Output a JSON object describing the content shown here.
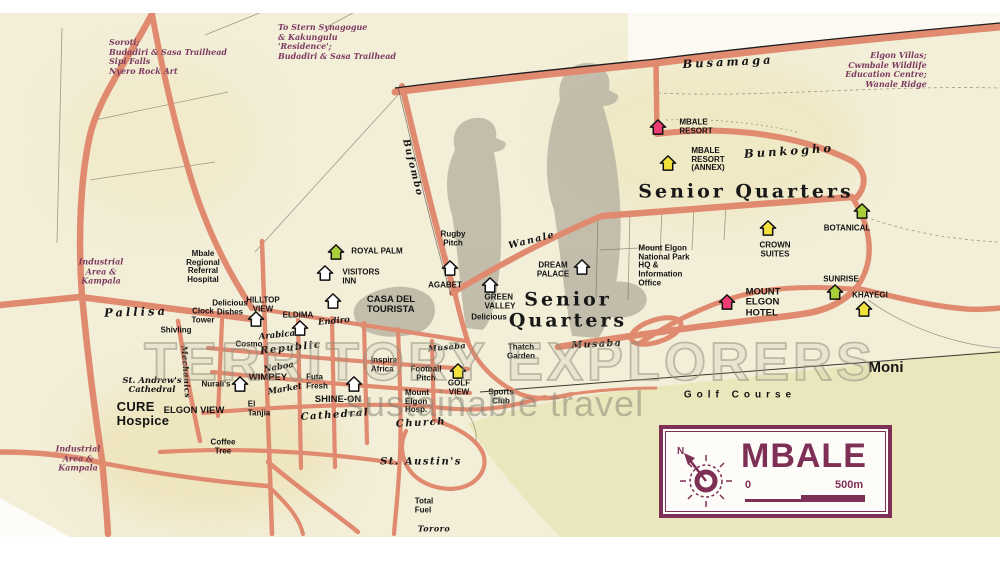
{
  "colors": {
    "road": "#e08a70",
    "paper": "#f3eed8",
    "legend_accent": "#7e2f55",
    "golf": "#eae5ba"
  },
  "legend": {
    "title": "MBALE",
    "scale_start": "0",
    "scale_end": "500m"
  },
  "watermark": {
    "line1": "TERRITORY EXPLORERS",
    "line2": "sustainable travel"
  },
  "map": {
    "labels": [
      {
        "n": "soroti-note",
        "t": "Soroti;\nBudadiri & Sasa Trailhead\nSipi Falls\nNyero Rock Art",
        "x": 168,
        "y": 57,
        "c": "note al"
      },
      {
        "n": "synagogue-note",
        "t": "To Stern Synagogue\n& Kakungulu\n'Residence';\nBudadiri & Sasa Trailhead",
        "x": 337,
        "y": 42,
        "c": "note al"
      },
      {
        "n": "elgon-villas-note",
        "t": "Elgon Villas;\nCwmbale Wildlife\nEducation Centre;\nWanale Ridge",
        "x": 886,
        "y": 70,
        "c": "note ar"
      },
      {
        "n": "industrial-kampala-note-1",
        "t": "Industrial\nArea &\nKampala",
        "x": 101,
        "y": 272,
        "c": "note"
      },
      {
        "n": "industrial-kampala-note-2",
        "t": "Industrial\nArea &\nKampala",
        "x": 78,
        "y": 459,
        "c": "note"
      },
      {
        "n": "busamaga-road-label",
        "t": "Busamaga",
        "x": 728,
        "y": 62,
        "c": "rdlg",
        "r": -3
      },
      {
        "n": "bunkogho-road-label",
        "t": "Bunkogho",
        "x": 789,
        "y": 151,
        "c": "rdlg",
        "r": -4
      },
      {
        "n": "bufombo-road-label",
        "t": "Bufombo",
        "x": 412,
        "y": 168,
        "c": "rdmd",
        "r": 76
      },
      {
        "n": "wanale-road-label",
        "t": "Wanale",
        "x": 532,
        "y": 241,
        "c": "rdmd",
        "r": -14
      },
      {
        "n": "pallisa-road-label",
        "t": "Pallisa",
        "x": 136,
        "y": 312,
        "c": "rdlg",
        "r": -2
      },
      {
        "n": "musaba-road-label-small",
        "t": "Musaba",
        "x": 447,
        "y": 347,
        "c": "rdsm",
        "r": -5
      },
      {
        "n": "musaba-road-label",
        "t": "Musaba",
        "x": 597,
        "y": 345,
        "c": "rdmd",
        "r": -3
      },
      {
        "n": "mechanics-road-label",
        "t": "Mechanics",
        "x": 186,
        "y": 372,
        "c": "rdsm",
        "r": 86
      },
      {
        "n": "naboa-road-label",
        "t": "Naboa",
        "x": 279,
        "y": 368,
        "c": "itsm",
        "r": -10
      },
      {
        "n": "market-road-label",
        "t": "Market",
        "x": 285,
        "y": 390,
        "c": "itsm",
        "r": -10
      },
      {
        "n": "cathedral-road-label",
        "t": "Cathedral",
        "x": 335,
        "y": 416,
        "c": "itmd",
        "r": -4
      },
      {
        "n": "church-road-label",
        "t": "Church",
        "x": 421,
        "y": 424,
        "c": "itmd",
        "r": -3
      },
      {
        "n": "tororo-road-label",
        "t": "Tororo",
        "x": 434,
        "y": 529,
        "c": "rdsm"
      },
      {
        "n": "republic-road-label",
        "t": "Republic",
        "x": 291,
        "y": 349,
        "c": "itmd",
        "r": -6
      },
      {
        "n": "arabica-road-label",
        "t": "Arabica",
        "x": 277,
        "y": 336,
        "c": "itsm",
        "r": -6
      },
      {
        "n": "senior-quarters-label-1",
        "t": "Senior Quarters",
        "x": 746,
        "y": 192,
        "c": "area"
      },
      {
        "n": "senior-quarters-label-2",
        "t": "Senior\nQuarters",
        "x": 568,
        "y": 310,
        "c": "area"
      },
      {
        "n": "moni-label",
        "t": "Moni",
        "x": 886,
        "y": 368,
        "c": "moni"
      },
      {
        "n": "golf-course-label",
        "t": "Golf Course",
        "x": 740,
        "y": 396,
        "c": "golfc"
      },
      {
        "n": "mbale-resort-label",
        "t": "MBALE\nRESORT",
        "x": 696,
        "y": 127,
        "c": "al"
      },
      {
        "n": "mbale-resort-annex-label",
        "t": "MBALE\nRESORT\n(ANNEX)",
        "x": 708,
        "y": 160,
        "c": "al"
      },
      {
        "n": "botanical-label",
        "t": "BOTANICAL",
        "x": 847,
        "y": 229
      },
      {
        "n": "crown-suites-label",
        "t": "CROWN\nSUITES",
        "x": 775,
        "y": 250
      },
      {
        "n": "sunrise-label",
        "t": "SUNRISE",
        "x": 841,
        "y": 280
      },
      {
        "n": "khayegi-label",
        "t": "KHAYEGI",
        "x": 870,
        "y": 296
      },
      {
        "n": "np-office-label",
        "t": "Mount Elgon\nNational Park\nHQ &\nInformation\nOffice",
        "x": 664,
        "y": 266,
        "c": "al"
      },
      {
        "n": "mount-elgon-hotel-label",
        "t": "MOUNT\nELGON\nHOTEL",
        "x": 763,
        "y": 303,
        "c": "p9 al"
      },
      {
        "n": "royal-palm-label",
        "t": "ROYAL PALM",
        "x": 377,
        "y": 252
      },
      {
        "n": "visitors-inn-label",
        "t": "VISITORS\nINN",
        "x": 361,
        "y": 277,
        "c": "al"
      },
      {
        "n": "casa-del-tourista-label",
        "t": "CASA DEL\nTOURISTA",
        "x": 391,
        "y": 305,
        "c": "p9 al"
      },
      {
        "n": "agabet-label",
        "t": "AGABET",
        "x": 445,
        "y": 286
      },
      {
        "n": "rugby-pitch-label",
        "t": "Rugby\nPitch",
        "x": 453,
        "y": 239
      },
      {
        "n": "dream-palace-label",
        "t": "DREAM\nPALACE",
        "x": 553,
        "y": 270
      },
      {
        "n": "green-valley-label",
        "t": "GREEN\nVALLEY",
        "x": 500,
        "y": 302,
        "c": "al"
      },
      {
        "n": "delicious-label",
        "t": "Delicious",
        "x": 489,
        "y": 318
      },
      {
        "n": "thatch-garden-label",
        "t": "Thatch\nGarden",
        "x": 521,
        "y": 352
      },
      {
        "n": "football-pitch-label",
        "t": "Football\nPitch",
        "x": 426,
        "y": 374
      },
      {
        "n": "golf-view-label",
        "t": "GOLF\nVIEW",
        "x": 459,
        "y": 388
      },
      {
        "n": "sports-club-label",
        "t": "Sports\nClub",
        "x": 501,
        "y": 397
      },
      {
        "n": "mount-elgon-hosp-label",
        "t": "Mount\nElgon\nHosp.",
        "x": 417,
        "y": 402,
        "c": "al"
      },
      {
        "n": "inspire-africa-label",
        "t": "Inspire\nAfrica",
        "x": 384,
        "y": 365,
        "c": "al"
      },
      {
        "n": "shine-on-label",
        "t": "SHINE-ON",
        "x": 338,
        "y": 400,
        "c": "p9"
      },
      {
        "n": "futa-fresh-label",
        "t": "Futa\nFresh",
        "x": 317,
        "y": 382,
        "c": "al"
      },
      {
        "n": "wimpey-label",
        "t": "WIMPEY",
        "x": 268,
        "y": 378,
        "c": "p9"
      },
      {
        "n": "eldima-label",
        "t": "ELDIMA",
        "x": 298,
        "y": 316
      },
      {
        "n": "hilltop-view-label",
        "t": "HILLTOP\nVIEW",
        "x": 263,
        "y": 305
      },
      {
        "n": "delicious-dishes-label",
        "t": "Delicious\nDishes",
        "x": 230,
        "y": 308
      },
      {
        "n": "clock-tower-label",
        "t": "Clock\nTower",
        "x": 203,
        "y": 316
      },
      {
        "n": "shivling-label",
        "t": "Shivling",
        "x": 176,
        "y": 331
      },
      {
        "n": "cosmo-label",
        "t": "Cosmo",
        "x": 249,
        "y": 345
      },
      {
        "n": "endiro-label",
        "t": "Endiro",
        "x": 334,
        "y": 322,
        "c": "itsm",
        "r": -5
      },
      {
        "n": "mbale-hospital-label",
        "t": "Mbale\nRegional\nReferral\nHospital",
        "x": 203,
        "y": 267
      },
      {
        "n": "st-andrews-label",
        "t": "St. Andrew's\nCathedral",
        "x": 152,
        "y": 386,
        "c": "itsm"
      },
      {
        "n": "cure-hospice-label",
        "t": "CURE\nHospice",
        "x": 143,
        "y": 414,
        "c": "p12 al"
      },
      {
        "n": "elgon-view-label",
        "t": "ELGON VIEW",
        "x": 194,
        "y": 411,
        "c": "p9"
      },
      {
        "n": "nuralis-label",
        "t": "Nurali's",
        "x": 216,
        "y": 385
      },
      {
        "n": "el-tanjia-label",
        "t": "El\nTanjia",
        "x": 259,
        "y": 409,
        "c": "al"
      },
      {
        "n": "coffee-tree-label",
        "t": "Coffee\nTree",
        "x": 223,
        "y": 447
      },
      {
        "n": "st-austins-label",
        "t": "St. Austin's",
        "x": 421,
        "y": 463,
        "c": "itmd"
      },
      {
        "n": "total-fuel-label",
        "t": "Total\nFuel",
        "x": 424,
        "y": 506,
        "c": "al"
      }
    ],
    "icons": [
      {
        "n": "mbale-resort-house-icon",
        "t": "house",
        "x": 658,
        "y": 127,
        "c": "#ee3d74"
      },
      {
        "n": "mbale-resort-annex-house-icon",
        "t": "house",
        "x": 668,
        "y": 163,
        "c": "#f3e23c"
      },
      {
        "n": "crown-suites-house-icon",
        "t": "house",
        "x": 768,
        "y": 228,
        "c": "#f3e23c"
      },
      {
        "n": "botanical-house-icon",
        "t": "house",
        "x": 862,
        "y": 211,
        "c": "#a9cf39"
      },
      {
        "n": "sunrise-house-icon",
        "t": "house",
        "x": 835,
        "y": 292,
        "c": "#a9cf39"
      },
      {
        "n": "khayegi-house-icon",
        "t": "house",
        "x": 864,
        "y": 309,
        "c": "#f3e23c"
      },
      {
        "n": "mount-elgon-hotel-house-icon",
        "t": "house",
        "x": 727,
        "y": 302,
        "c": "#ee3d74"
      },
      {
        "n": "royal-palm-house-icon",
        "t": "house",
        "x": 336,
        "y": 252,
        "c": "#a9cf39"
      },
      {
        "n": "visitors-inn-house-icon",
        "t": "house",
        "x": 325,
        "y": 273,
        "c": "#ffffff"
      },
      {
        "n": "casa-del-tourista-house-icon",
        "t": "house",
        "x": 333,
        "y": 301,
        "c": "#ffffff"
      },
      {
        "n": "agabet-house-icon",
        "t": "house",
        "x": 450,
        "y": 268,
        "c": "#ffffff"
      },
      {
        "n": "dream-palace-house-icon",
        "t": "house",
        "x": 582,
        "y": 267,
        "c": "#ffffff"
      },
      {
        "n": "green-valley-house-icon",
        "t": "house",
        "x": 490,
        "y": 285,
        "c": "#ffffff"
      },
      {
        "n": "hilltop-view-house-icon",
        "t": "house",
        "x": 256,
        "y": 319,
        "c": "#ffffff"
      },
      {
        "n": "eldima-house-icon",
        "t": "house",
        "x": 300,
        "y": 328,
        "c": "#ffffff"
      },
      {
        "n": "wimpey-house-icon",
        "t": "house",
        "x": 240,
        "y": 384,
        "c": "#ffffff"
      },
      {
        "n": "shine-on-house-icon",
        "t": "house",
        "x": 354,
        "y": 384,
        "c": "#ffffff"
      },
      {
        "n": "golf-view-house-icon",
        "t": "house",
        "x": 458,
        "y": 371,
        "c": "#f3e23c"
      },
      {
        "n": "annex-pool-icon",
        "t": "cyansq",
        "x": 673,
        "y": 146
      },
      {
        "n": "hotel-pool-icon",
        "t": "cyansq",
        "x": 734,
        "y": 317
      },
      {
        "n": "np-office-icon",
        "t": "greensq",
        "x": 684,
        "y": 293
      },
      {
        "n": "fuel-shell-icon-1",
        "t": "shell",
        "x": 205,
        "y": 222
      },
      {
        "n": "fuel-shell-icon-2",
        "t": "shell",
        "x": 232,
        "y": 214
      },
      {
        "n": "fuel-shell-icon-3",
        "t": "shell",
        "x": 165,
        "y": 455
      },
      {
        "n": "fuel-shell-icon-4",
        "t": "shell",
        "x": 383,
        "y": 403
      },
      {
        "n": "thatch-garden-logo-icon",
        "t": "brand",
        "x": 545,
        "y": 351
      },
      {
        "n": "golf-view-logo-icon",
        "t": "brand",
        "x": 485,
        "y": 387
      },
      {
        "n": "delicious-dishes-food-icon",
        "t": "plate",
        "x": 238,
        "y": 321
      },
      {
        "n": "cosmo-food-icon",
        "t": "plate",
        "x": 225,
        "y": 342
      },
      {
        "n": "futa-fresh-food-icon",
        "t": "plate",
        "x": 337,
        "y": 382
      },
      {
        "n": "coffee-tree-food-icon",
        "t": "plate",
        "x": 218,
        "y": 430
      },
      {
        "n": "elgon-view-food-icon",
        "t": "plate",
        "x": 211,
        "y": 398,
        "c": "#6cc24a"
      },
      {
        "n": "endiro-coffee-icon",
        "t": "cup",
        "x": 328,
        "y": 332
      },
      {
        "n": "casa-coffee-icon",
        "t": "cup",
        "x": 347,
        "y": 305
      },
      {
        "n": "inspire-africa-coffee-icon",
        "t": "cup",
        "x": 375,
        "y": 378
      },
      {
        "n": "arabica-coffee-icon",
        "t": "cup",
        "x": 273,
        "y": 327
      },
      {
        "n": "shivling-cart-icon",
        "t": "cart",
        "x": 204,
        "y": 334
      },
      {
        "n": "nuralis-cart-icon",
        "t": "cart",
        "x": 216,
        "y": 368
      },
      {
        "n": "el-tanjia-music-icon",
        "t": "music",
        "x": 236,
        "y": 407
      },
      {
        "n": "market-arches-icon",
        "t": "m",
        "x": 288,
        "y": 421
      },
      {
        "n": "bus-park-icon",
        "t": "bus",
        "x": 243,
        "y": 444
      },
      {
        "n": "mbale-hospital-cross-icon",
        "t": "crossblue",
        "x": 173,
        "y": 275,
        "s": 15
      },
      {
        "n": "cure-hospice-cross-icon",
        "t": "crossblue",
        "x": 82,
        "y": 410,
        "s": 17
      },
      {
        "n": "mount-elgon-hosp-cross-icon",
        "t": "crossblue",
        "x": 438,
        "y": 403,
        "s": 14
      },
      {
        "n": "st-andrews-cross-icon",
        "t": "crosswhite",
        "x": 158,
        "y": 361,
        "s": 17
      },
      {
        "n": "st-austins-cross-icon",
        "t": "crosswhite",
        "x": 422,
        "y": 444,
        "s": 22
      },
      {
        "n": "church-building-icon",
        "t": "bldg",
        "x": 441,
        "y": 428
      },
      {
        "n": "information-icon",
        "t": "info",
        "x": 395,
        "y": 341
      },
      {
        "n": "post-office-icon",
        "t": "env",
        "x": 381,
        "y": 333
      },
      {
        "n": "supermarket-icon-1",
        "t": "scircle",
        "x": 352,
        "y": 323,
        "ch": "S"
      },
      {
        "n": "supermarket-icon-2",
        "t": "scircle",
        "x": 367,
        "y": 338,
        "ch": "S"
      },
      {
        "n": "forex-icon-1",
        "t": "scircle",
        "x": 333,
        "y": 352,
        "ch": "$"
      },
      {
        "n": "forex-icon-2",
        "t": "scircle",
        "x": 353,
        "y": 354,
        "ch": "$"
      },
      {
        "n": "hexagon-marker-icon",
        "t": "hex",
        "x": 317,
        "y": 349
      },
      {
        "n": "delicious-park-icon",
        "t": "tripark",
        "x": 494,
        "y": 336
      },
      {
        "n": "traffic-light-icon",
        "t": "traffic",
        "x": 82,
        "y": 295
      },
      {
        "n": "total-fuel-dot-icon",
        "t": "dot",
        "x": 401,
        "y": 512
      },
      {
        "n": "kampala-arrow-icon-1",
        "t": "arrow",
        "x": 100,
        "y": 255
      },
      {
        "n": "kampala-arrow-icon-2",
        "t": "arrow",
        "x": 79,
        "y": 442
      },
      {
        "n": "casa-flag-icon",
        "t": "flag",
        "x": 342,
        "y": 296
      },
      {
        "n": "pallisa-square-icon",
        "t": "sq",
        "x": 113,
        "y": 307
      },
      {
        "n": "roundabout-icon-1",
        "t": "junction",
        "x": 94,
        "y": 412
      },
      {
        "n": "roundabout-icon-2",
        "t": "junction",
        "x": 378,
        "y": 380
      },
      {
        "n": "roundabout-icon-3",
        "t": "junction",
        "x": 521,
        "y": 381
      },
      {
        "n": "roundabout-icon-4",
        "t": "junction",
        "x": 658,
        "y": 331
      }
    ]
  }
}
